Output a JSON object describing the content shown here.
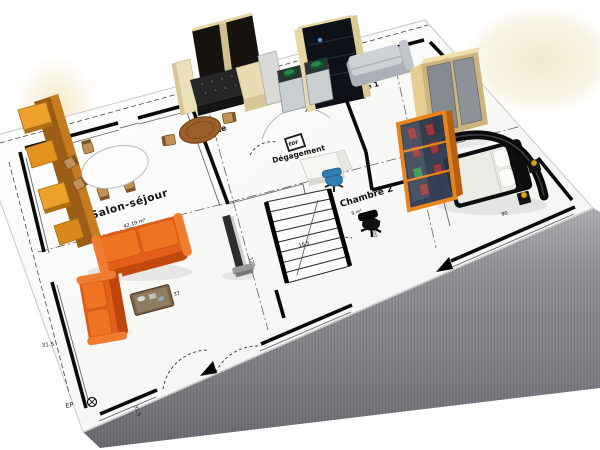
{
  "scene": {
    "background": "#ffffff",
    "paper_color": "#fdfdfd",
    "slab_side_color": "#909297"
  },
  "rooms": {
    "salon": {
      "name": "Salon-séjour",
      "area": "42.19 m²"
    },
    "cuisine": {
      "name": "Cuisine"
    },
    "degagement": {
      "name": "Dégagement"
    },
    "edf": {
      "name": "EDF"
    },
    "chambre1": {
      "name": "Chambre 1"
    },
    "chambre2": {
      "name": "Chambre 2",
      "area": "9 m²"
    }
  },
  "dimensions": {
    "left": "31.5",
    "bottom": "31.5",
    "drain": "EP",
    "coffee": "37",
    "stair": "123",
    "hall": "16.5",
    "chambre2": "300",
    "bed": "90"
  },
  "colors": {
    "sofa_orange": "#e4601a",
    "frame_orange": "#e8831e",
    "cabinet_cream": "#e9dcb0",
    "counter_dark": "#1d1d1d",
    "wood": "#9c5f2a",
    "chair_blue": "#2f80b2",
    "appliance_green": "#2e8b52",
    "wardrobe_tan": "#d8c088",
    "bed_dark": "#101214"
  }
}
